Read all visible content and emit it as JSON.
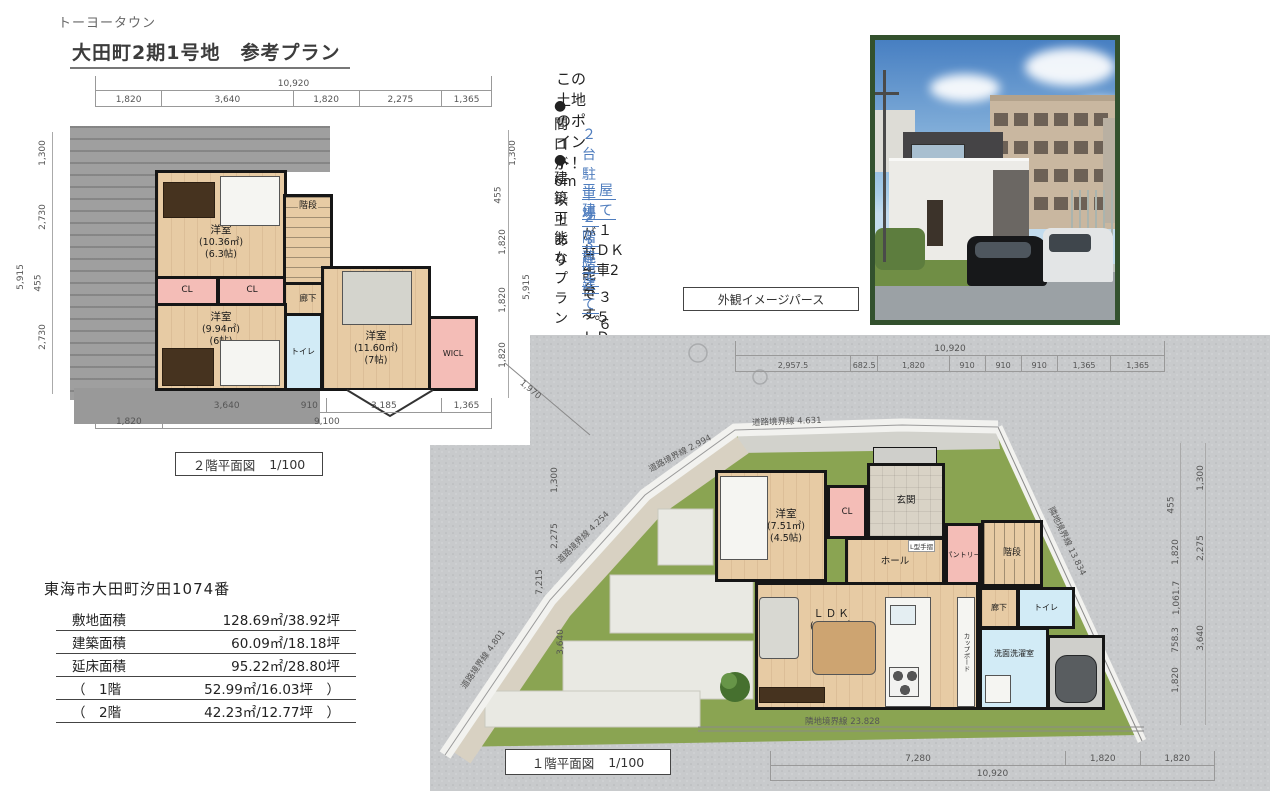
{
  "header": {
    "brand": "トーヨータウン",
    "title": "大田町2期1号地　参考プラン"
  },
  "points": {
    "title": "この土地のポイント！",
    "bullet": "●",
    "item1": "間口が6m以上あり",
    "item1_highlight": "２台駐車場",
    "item1_rest": "が可能です。",
    "item2": "建築可能なプラン",
    "plans": [
      {
        "link": "平屋建て",
        "desc": "１ＬＤＫ　　＋車2台"
      },
      {
        "link": "２階建て",
        "desc": "３～５ＬＤＫ＋車３台"
      },
      {
        "link": "３階建て",
        "desc": "６＋２ＬＤＫ＋車２台"
      }
    ]
  },
  "photo": {
    "caption": "外観イメージパース"
  },
  "plan2f": {
    "title": "２階平面図",
    "scale": "1/100",
    "dim_total_top": "10,920",
    "dims_top": [
      "1,820",
      "3,640",
      "1,820",
      "2,275",
      "1,365"
    ],
    "left_top": "1,300",
    "left_total": "5,915",
    "dims_left": [
      "2,730",
      "455",
      "2,730"
    ],
    "right_top": "1,300",
    "right_total": "5,915",
    "dims_right": [
      "455",
      "1,820",
      "1,820",
      "1,820"
    ],
    "dims_bottom": [
      "3,640",
      "910",
      "3,185",
      "1,365"
    ],
    "dim_bottom_left": "1,820",
    "dim_bottom_total": "9,100",
    "room1": {
      "name": "洋室",
      "area": "(10.36㎡)",
      "tatami": "(6.3帖)"
    },
    "room2": {
      "name": "洋室",
      "area": "(9.94㎡)",
      "tatami": "(6帖)"
    },
    "room3": {
      "name": "洋室",
      "area": "(11.60㎡)",
      "tatami": "(7帖)"
    },
    "cl1": "CL",
    "cl2": "CL",
    "stairs": "階段",
    "hallway": "廊下",
    "toilet": "トイレ",
    "wicl": "WICL"
  },
  "plan1f": {
    "title": "１階平面図",
    "scale": "1/100",
    "dim_total_top": "10,920",
    "dims_top": [
      "2,957.5",
      "682.5",
      "1,820",
      "910",
      "910",
      "910",
      "1,365",
      "1,365"
    ],
    "dims_left": [
      "1,300",
      "2,275",
      "7,215",
      "3,640"
    ],
    "dims_right_inner": [
      "455",
      "1,820",
      "1,061.7",
      "758.3",
      "1,820"
    ],
    "dims_right_outer": [
      "1,300",
      "2,275",
      "3,640"
    ],
    "dims_bottom": [
      "7,280",
      "1,820",
      "1,820"
    ],
    "dim_bottom_total": "10,920",
    "diag_dim": "1,970",
    "boundaries": {
      "road_top": "道路境界線 4.631",
      "road2": "道路境界線 2.994",
      "road3": "道路境界線 4.254",
      "road4": "道路境界線 4.801",
      "neighbor_right": "隣地境界線 13.834",
      "neighbor_bottom": "隣地境界線 23.828"
    },
    "bedroom": {
      "name": "洋室",
      "area": "(7.51㎡)",
      "tatami": "(4.5帖)"
    },
    "ldk": {
      "name": "ＬＤＫ",
      "area": "(26.50㎡)",
      "tatami": "(16帖)"
    },
    "cl": "CL",
    "entrance": "玄関",
    "hall": "ホール",
    "handrail": "L型手摺",
    "pantry": "パントリー",
    "stairs": "階段",
    "hallway": "廊下",
    "toilet": "トイレ",
    "washroom": "洗面洗濯室",
    "cupboard": "カップボード"
  },
  "property": {
    "address": "東海市大田町汐田1074番",
    "rows": [
      {
        "label": "敷地面積",
        "value": "128.69㎡/38.92坪"
      },
      {
        "label": "建築面積",
        "value": "60.09㎡/18.18坪"
      },
      {
        "label": "延床面積",
        "value": "95.22㎡/28.80坪"
      },
      {
        "label": "（　1階",
        "value": "52.99㎡/16.03坪　）"
      },
      {
        "label": "（　2階",
        "value": "42.23㎡/12.77坪　）"
      }
    ]
  }
}
